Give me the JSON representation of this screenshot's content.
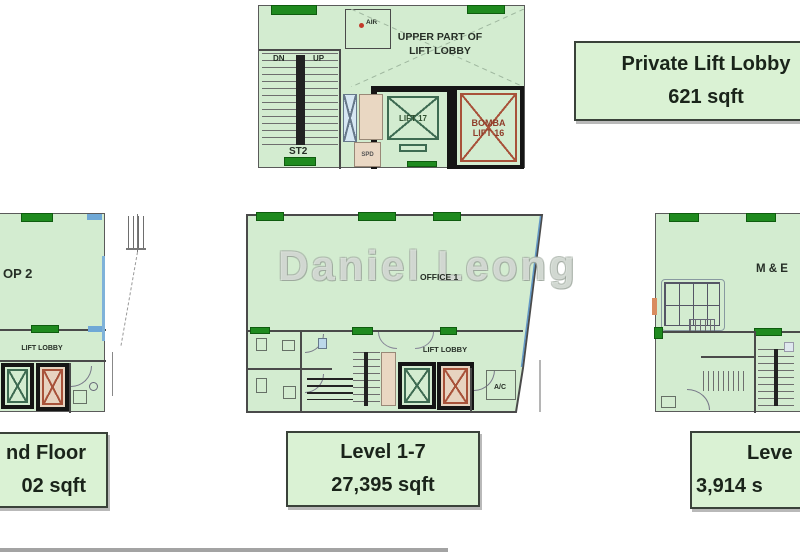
{
  "canvas": {
    "width": 800,
    "height": 552
  },
  "colors": {
    "plan_fill": "#d3ecd0",
    "wall": "#4a4a4a",
    "column_green": "#1f8a1f",
    "accent_blue": "#6fa8d6",
    "bomba_red": "#a8523a",
    "callout_fill": "#daf2d4",
    "callout_border": "#3a423a",
    "callout_text": "#1a241a"
  },
  "upper_plan": {
    "room_label_line1": "UPPER PART OF",
    "room_label_line2": "LIFT LOBBY",
    "stairs_down": "DN",
    "stairs_up": "UP",
    "stair_id": "ST2",
    "spd_label": "SPD",
    "air_label": "AIR",
    "lift_17": "LIFT 17",
    "bomba_lift_16": "BOMBA LIFT 16"
  },
  "left_plan": {
    "shop_label": "OP 2",
    "lift_lobby": "LIFT LOBBY"
  },
  "center_plan": {
    "watermark": "Daniel Leong",
    "office_label": "OFFICE 1",
    "lift_lobby": "LIFT LOBBY",
    "ac_label": "A/C"
  },
  "right_plan": {
    "me_label": "M & E"
  },
  "callouts": {
    "private_lift_lobby": {
      "line1": "Private Lift Lobby",
      "line2": "621 sqft"
    },
    "ground_floor": {
      "line1": "nd Floor",
      "line2": "02 sqft"
    },
    "level_1_7": {
      "line1": "Level 1-7",
      "line2": "27,395 sqft"
    },
    "level_8": {
      "line1": "Leve",
      "line2": "3,914 s"
    }
  }
}
